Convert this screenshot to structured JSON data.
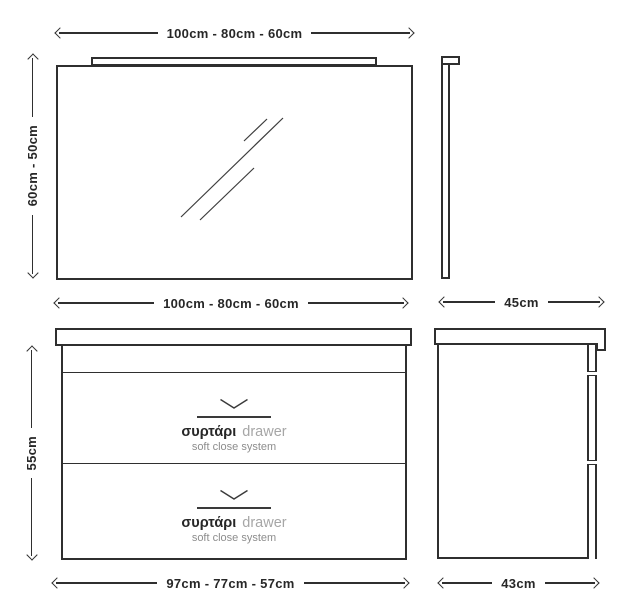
{
  "colors": {
    "line": "#2f2f2f",
    "text": "#272727",
    "muted_text": "#a6a6a6",
    "subtitle_text": "#8d8d8d",
    "background": "#ffffff"
  },
  "mirror": {
    "width_label": "100cm - 80cm - 60cm",
    "height_label": "60cm - 50cm",
    "side_depth_label": "45cm"
  },
  "cabinet": {
    "top_width_label": "100cm - 80cm - 60cm",
    "height_label": "55cm",
    "bottom_width_label": "97cm - 77cm - 57cm",
    "side_depth_label": "43cm",
    "drawer_count": 2,
    "drawer": {
      "label_greek": "συρτάρι",
      "label_english": "drawer",
      "subtitle": "soft close system",
      "open_icon": "chevron-down"
    }
  }
}
